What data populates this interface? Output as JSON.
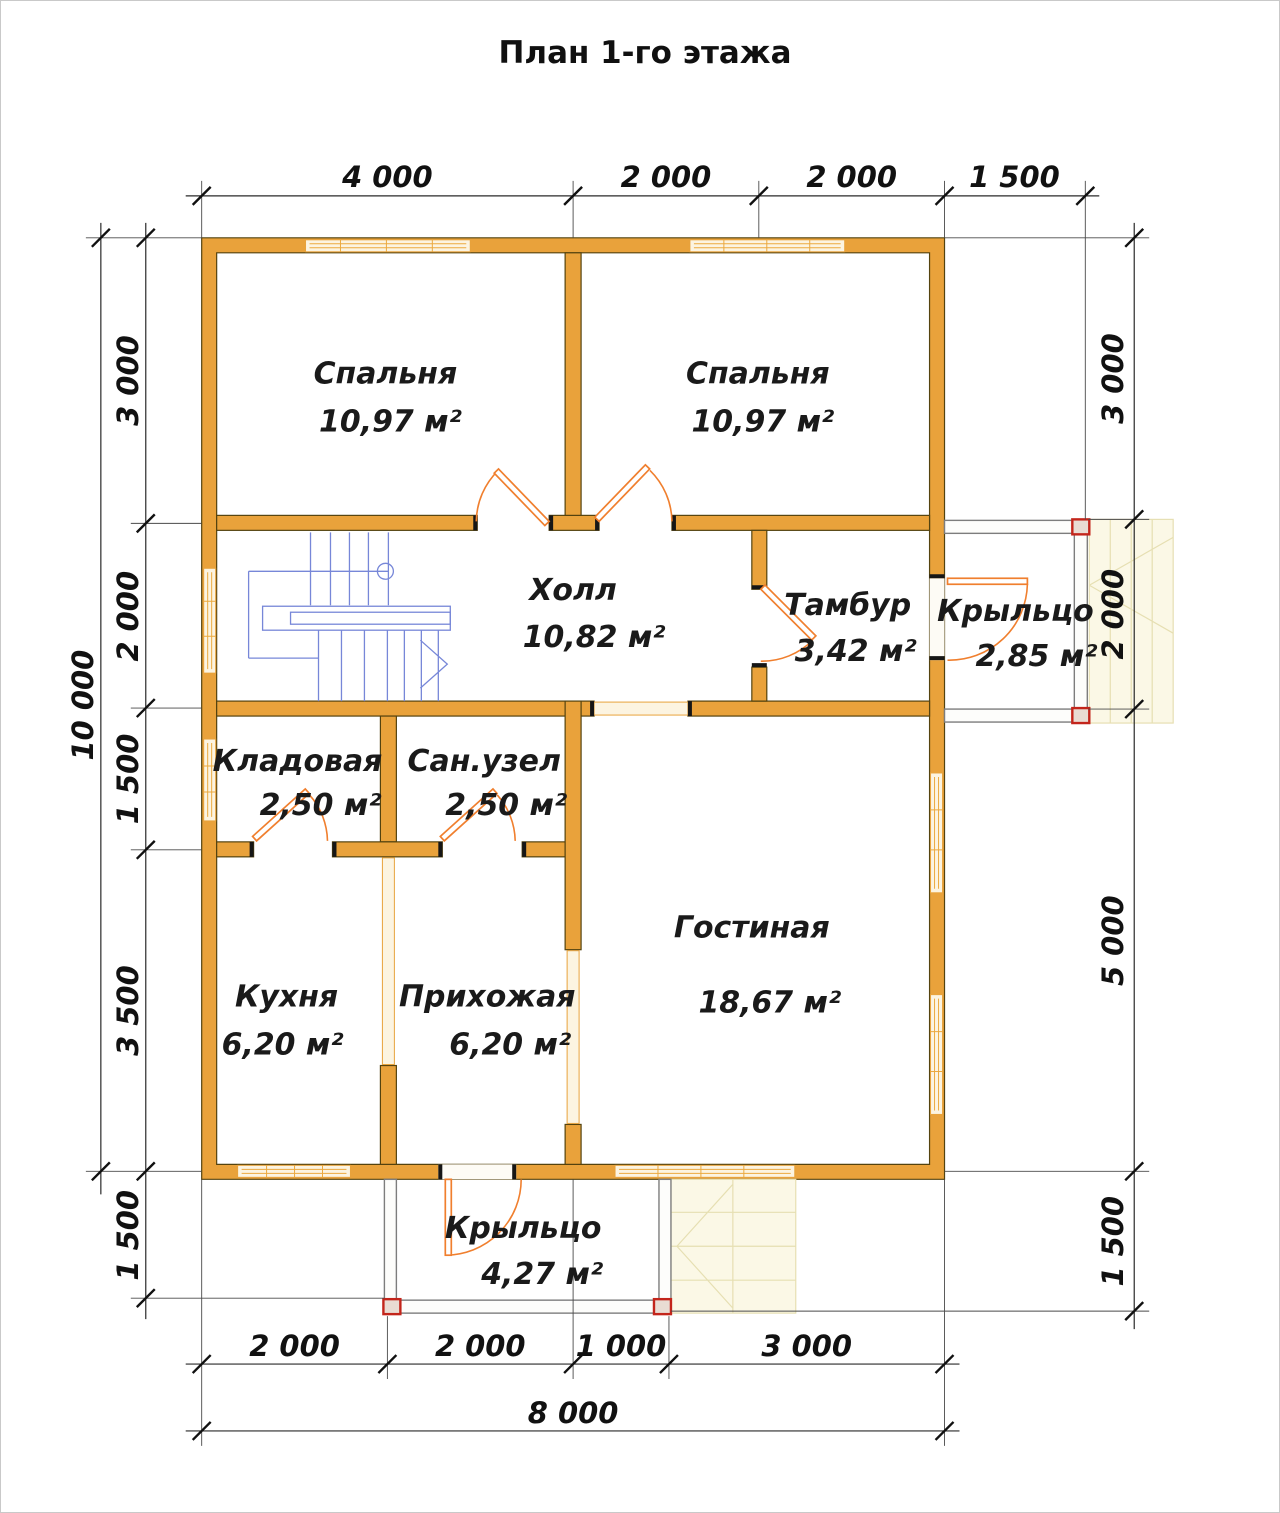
{
  "title": "План 1-го этажа",
  "rooms": {
    "bedroom_left": {
      "name": "Спальня",
      "area": "10,97 м²"
    },
    "bedroom_right": {
      "name": "Спальня",
      "area": "10,97 м²"
    },
    "hall": {
      "name": "Холл",
      "area": "10,82 м²"
    },
    "tambour": {
      "name": "Тамбур",
      "area": "3,42 м²"
    },
    "porch_right": {
      "name": "Крыльцо",
      "area": "2,85 м²"
    },
    "storage": {
      "name": "Кладовая",
      "area": "2,50 м²"
    },
    "bathroom": {
      "name": "Сан.узел",
      "area": "2,50 м²"
    },
    "kitchen": {
      "name": "Кухня",
      "area": "6,20 м²"
    },
    "hallway": {
      "name": "Прихожая",
      "area": "6,20 м²"
    },
    "living_room": {
      "name": "Гостиная",
      "area": "18,67 м²"
    },
    "porch_bottom": {
      "name": "Крыльцо",
      "area": "4,27 м²"
    }
  },
  "dimensions": {
    "top": [
      "4 000",
      "2 000",
      "2 000",
      "1 500"
    ],
    "left_inner": [
      "3 000",
      "2 000",
      "1 500",
      "3 500",
      "1 500"
    ],
    "left_outer": "10 000",
    "right": [
      "3 000",
      "2 000",
      "5 000",
      "1 500"
    ],
    "bottom_inner": [
      "2 000",
      "2 000",
      "1 000",
      "3 000"
    ],
    "bottom_outer": "8 000"
  },
  "colors": {
    "wall": "#E9A23B",
    "wall_outline": "#54430F",
    "door": "#F07F2E",
    "window_frame": "#E8A33C",
    "stairs": "#7787D8",
    "porch_post_red": "#C3251B",
    "dimension": "#111111"
  }
}
